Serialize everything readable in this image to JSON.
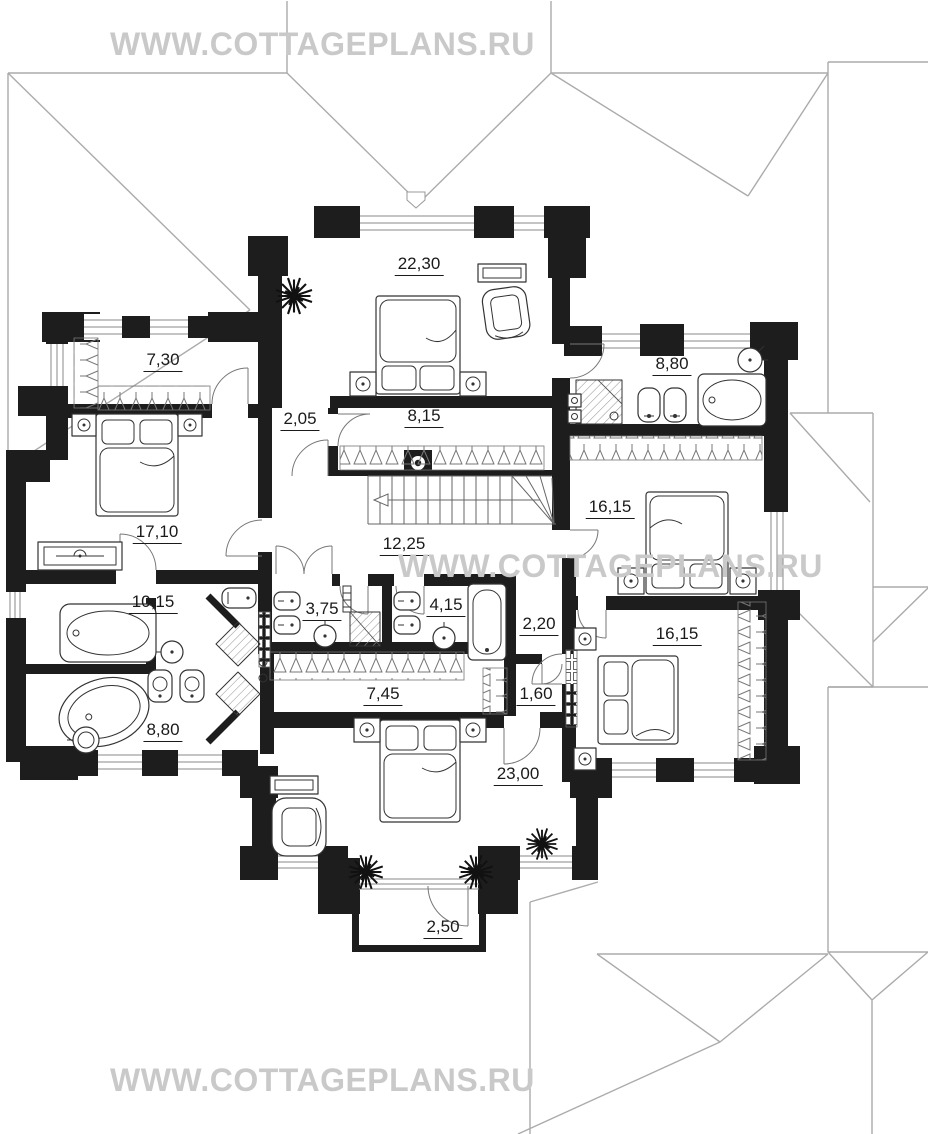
{
  "watermark": {
    "text": "WWW.COTTAGEPLANS.RU"
  },
  "plan": {
    "type": "floor-plan",
    "floor": "second",
    "rooms": [
      {
        "id": "bedroom-top-center",
        "area": "22,30"
      },
      {
        "id": "wardrobe-top-left",
        "area": "7,30"
      },
      {
        "id": "bathroom-top-right",
        "area": "8,80"
      },
      {
        "id": "hallway-2-05",
        "area": "2,05"
      },
      {
        "id": "wardrobe-8-15",
        "area": "8,15"
      },
      {
        "id": "bedroom-right-upper",
        "area": "16,15"
      },
      {
        "id": "bedroom-left",
        "area": "17,10"
      },
      {
        "id": "hall-12-25",
        "area": "12,25"
      },
      {
        "id": "hallway-10-15",
        "area": "10,15"
      },
      {
        "id": "bathroom-3-75",
        "area": "3,75"
      },
      {
        "id": "bathroom-4-15",
        "area": "4,15"
      },
      {
        "id": "hallway-2-20",
        "area": "2,20"
      },
      {
        "id": "bedroom-right-lower",
        "area": "16,15"
      },
      {
        "id": "wardrobe-7-45",
        "area": "7,45"
      },
      {
        "id": "hallway-1-60",
        "area": "1,60"
      },
      {
        "id": "bathroom-bottom-left",
        "area": "8,80"
      },
      {
        "id": "bedroom-bottom-center",
        "area": "23,00"
      },
      {
        "id": "balcony",
        "area": "2,50"
      }
    ]
  },
  "colors": {
    "wall": "#1d1d1d",
    "roof_line": "#ababab",
    "furniture_line": "#333333",
    "watermark": "#c9c9c9",
    "label": "#1a1a1a"
  }
}
